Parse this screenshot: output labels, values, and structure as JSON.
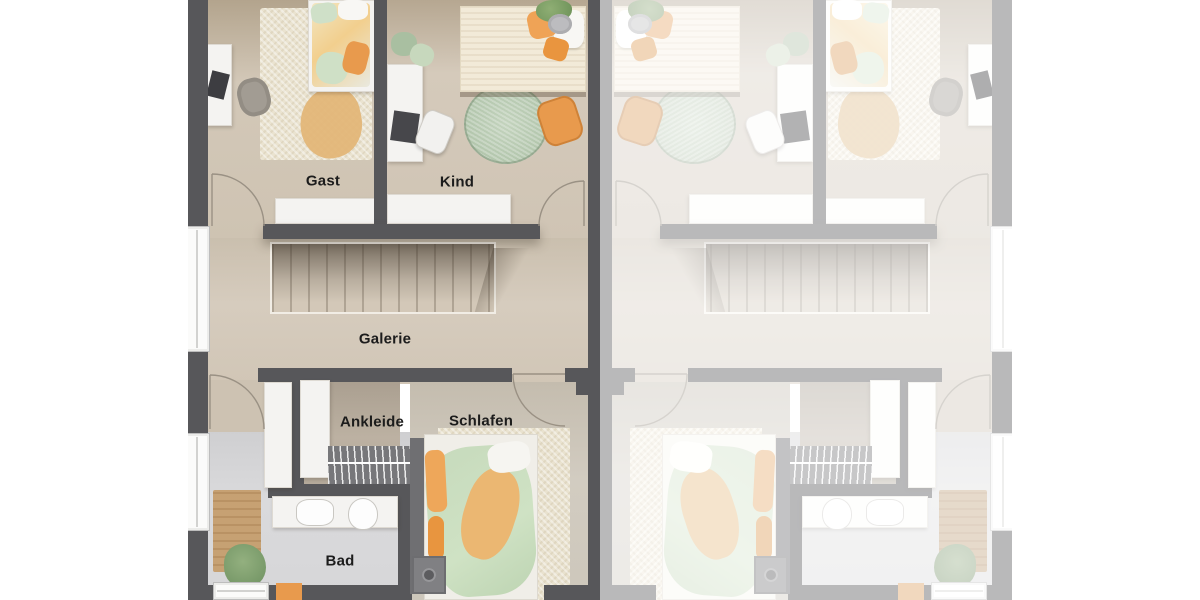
{
  "plan": {
    "kind": "residential-floor-plan",
    "halves": {
      "left": "vivid-unit-with-labels",
      "right": "mirrored-faded-unit-no-labels"
    }
  },
  "rooms": [
    {
      "id": "gast",
      "label": "Gast"
    },
    {
      "id": "kind",
      "label": "Kind"
    },
    {
      "id": "galerie",
      "label": "Galerie"
    },
    {
      "id": "ankleide",
      "label": "Ankleide"
    },
    {
      "id": "schlafen",
      "label": "Schlafen"
    },
    {
      "id": "bad",
      "label": "Bad"
    }
  ],
  "colors": {
    "background": "#ffffff",
    "wall": "#57575a",
    "floor-wood": "#cfc4b3",
    "floor-galerie": "#d2c7b8",
    "floor-ankleide": "#b7ac9e",
    "floor-bad": "#d7d7d9",
    "rug-cream": "#eae3d0",
    "rug-sage": "#abc0a5",
    "accent-orange": "#e89a4d",
    "accent-green": "#c6dabc",
    "furniture-white": "#f4f3f1",
    "label-text": "#1c1c1c"
  }
}
